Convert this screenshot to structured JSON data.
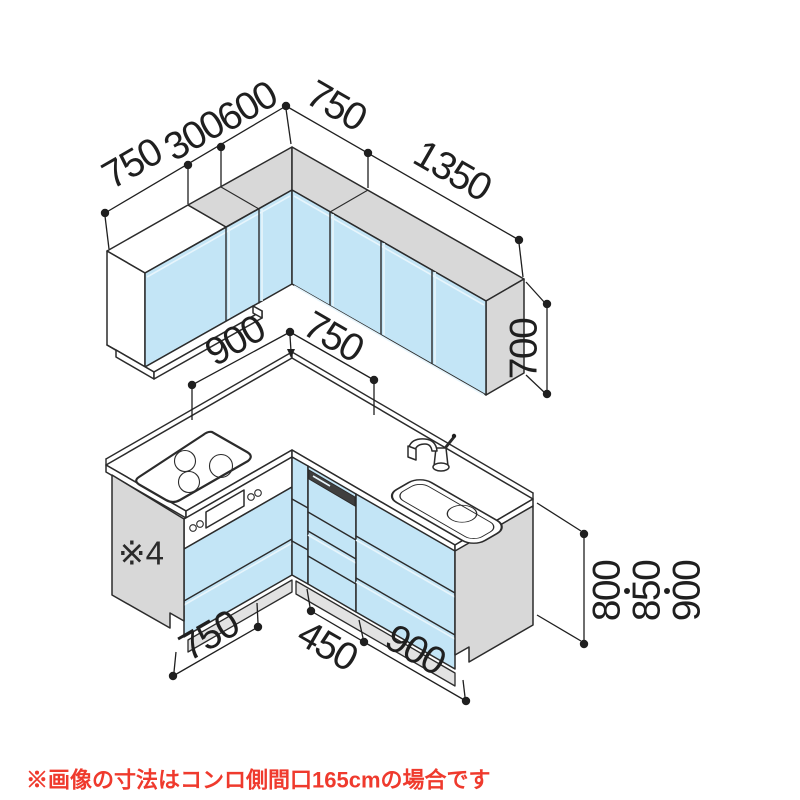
{
  "note": {
    "text": "※画像の寸法はコンロ側間口165cmの場合です",
    "color": "#ef3a2d"
  },
  "annotation": {
    "side_panel": "※4"
  },
  "dims": {
    "wall_left_750": "750",
    "wall_left_300": "300",
    "wall_left_600": "600",
    "wall_right_750": "750",
    "wall_right_1350": "1350",
    "wall_height": "700",
    "counter_left": "900",
    "counter_right": "750",
    "base_left": "750",
    "base_mid": "450",
    "base_right": "900",
    "height_a": "800",
    "height_b": "850",
    "height_c": "900"
  },
  "colors": {
    "cabinet_blue": "#c3e5f6",
    "panel_gray": "#d8d8d8",
    "outline": "#2b2b2b",
    "note_red": "#ef3a2d"
  }
}
